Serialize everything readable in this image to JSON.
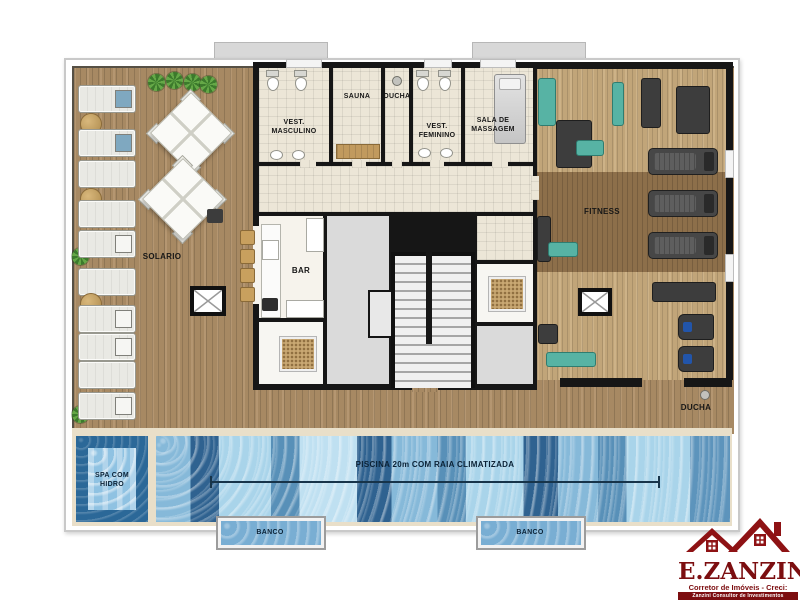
{
  "plan": {
    "solario_label": "SOLARIO",
    "vest_masc_label": "VEST.\nMASCULINO",
    "sauna_label": "SAUNA",
    "ducha_label": "DUCHA",
    "vest_fem_label": "VEST.\nFEMININO",
    "massagem_label": "SALA DE\nMASSAGEM",
    "fitness_label": "FITNESS",
    "bar_label": "BAR",
    "ducha_externa_label": "DUCHA",
    "spa_label": "SPA COM\nHIDRO",
    "piscina_label": "PISCINA 20m COM RAIA CLIMATIZADA",
    "banco_left_label": "BANCO",
    "banco_right_label": "BANCO"
  },
  "logo": {
    "name": "E.ZANZINI",
    "tagline": "Corretor de Imóveis - Creci: 165666-F",
    "subtagline": "Zanzini Consultor de Investimentos Imobiliários"
  },
  "colors": {
    "deck_wood": "#b09068",
    "fitness_wood": "#c9ac7e",
    "fitness_band": "#8d6f4a",
    "pool_light": "#a9d4ea",
    "pool_dark": "#2f6290",
    "spa_border": "#2b6898",
    "wall": "#161616",
    "logo_red": "#7c0e10",
    "equipment_teal": "#57b3a4"
  }
}
